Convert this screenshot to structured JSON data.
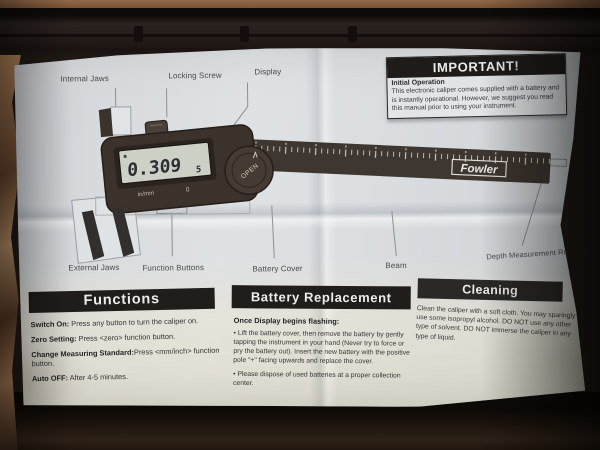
{
  "diagram": {
    "labels": {
      "internal_jaws": "Internal Jaws",
      "locking_screw": "Locking Screw",
      "display": "Display",
      "external_jaws": "External Jaws",
      "function_buttons": "Function Buttons",
      "battery_cover": "Battery Cover",
      "beam": "Beam",
      "depth_rod": "Depth Measurement Rod"
    },
    "caliper": {
      "brand": "Fowler",
      "display_value": "0.309",
      "display_half_digit": "5",
      "unit_button": "in/mm",
      "zero_button": "0",
      "battery_cover_text": "OPEN"
    }
  },
  "important_box": {
    "title": "IMPORTANT!",
    "subtitle": "Initial Operation",
    "body": "This electronic caliper comes supplied with a battery and is instantly operational. However, we suggest you read this manual prior to using your instrument."
  },
  "sections": {
    "functions": {
      "title": "Functions",
      "items": [
        {
          "lead": "Switch On:",
          "text": " Press any button to turn the caliper on."
        },
        {
          "lead": "Zero Setting:",
          "text": " Press <zero> function button."
        },
        {
          "lead": "Change Measuring Standard:",
          "text": "Press <mm/inch> function button."
        },
        {
          "lead": "Auto OFF:",
          "text": " After 4-5 minutes."
        }
      ]
    },
    "battery": {
      "title": "Battery Replacement",
      "intro": "Once Display begins flashing:",
      "bullets": [
        "• Lift the battery cover, then remove the battery by gently tapping the instrument in your hand (Never try to force or pry the battery out). Insert the new battery with the positive pole \"+\" facing upwards and replace the cover.",
        "• Please dispose of used batteries at a proper collection center."
      ]
    },
    "cleaning": {
      "title": "Cleaning",
      "body": "Clean the caliper with a soft cloth. You may sparingly use some isopropyl alcohol. DO NOT use any other type of solvent. DO NOT immerse the caliper in any type of liquid."
    }
  },
  "colors": {
    "paper": "#dadde0",
    "ink": "#333335",
    "header_bar": "#201d1b",
    "caliper_body": "#3b322b",
    "lcd": "#ccd0c5",
    "case": "#241d19",
    "table_edge": "#b5825f",
    "bag": "#b98a63"
  }
}
